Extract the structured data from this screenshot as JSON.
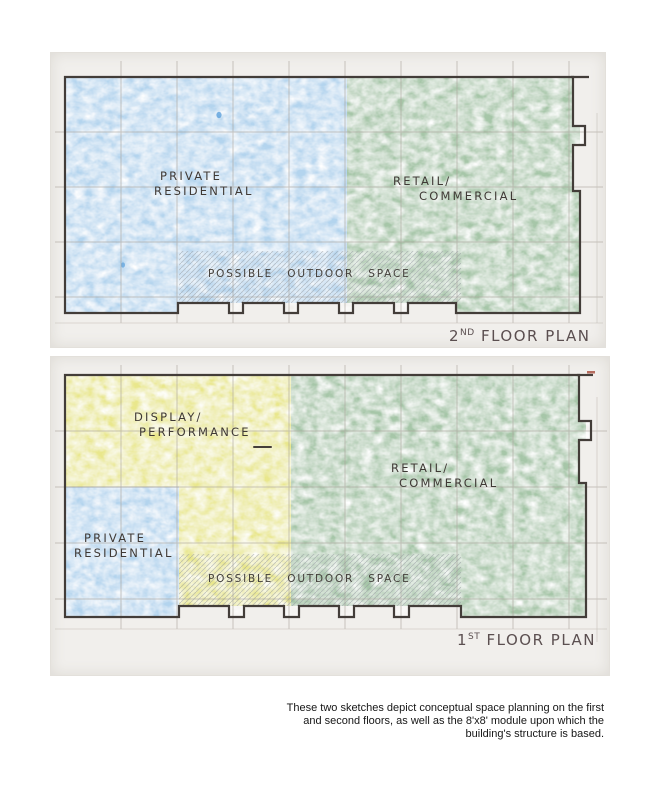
{
  "sketches": {
    "second_floor": {
      "title": {
        "num": "2",
        "sup": "ND",
        "rest": " FLOOR PLAN"
      },
      "labels": {
        "private_line1": "PRIVATE",
        "private_line2": "RESIDENTIAL",
        "retail_line1": "RETAIL/",
        "retail_line2": "COMMERCIAL",
        "outdoor": "POSSIBLE OUTDOOR SPACE"
      },
      "colors": {
        "residential": "#b3d4ee",
        "retail": "#a6c6a8"
      }
    },
    "first_floor": {
      "title": {
        "num": "1",
        "sup": "ST",
        "rest": " FLOOR PLAN"
      },
      "labels": {
        "display_line1": "DISPLAY/",
        "display_line2": "PERFORMANCE",
        "private_line1": "PRIVATE",
        "private_line2": "RESIDENTIAL",
        "retail_line1": "RETAIL/",
        "retail_line2": "COMMERCIAL",
        "outdoor": "POSSIBLE OUTDOOR SPACE"
      },
      "colors": {
        "display": "#e9e78c",
        "residential": "#b3d4ee",
        "retail": "#a6c6a8"
      }
    }
  },
  "caption": {
    "lines": [
      "These two sketches depict conceptual space planning on the first",
      "and second floors, as well as the 8'x8' module upon which the",
      "building's structure is based."
    ]
  }
}
